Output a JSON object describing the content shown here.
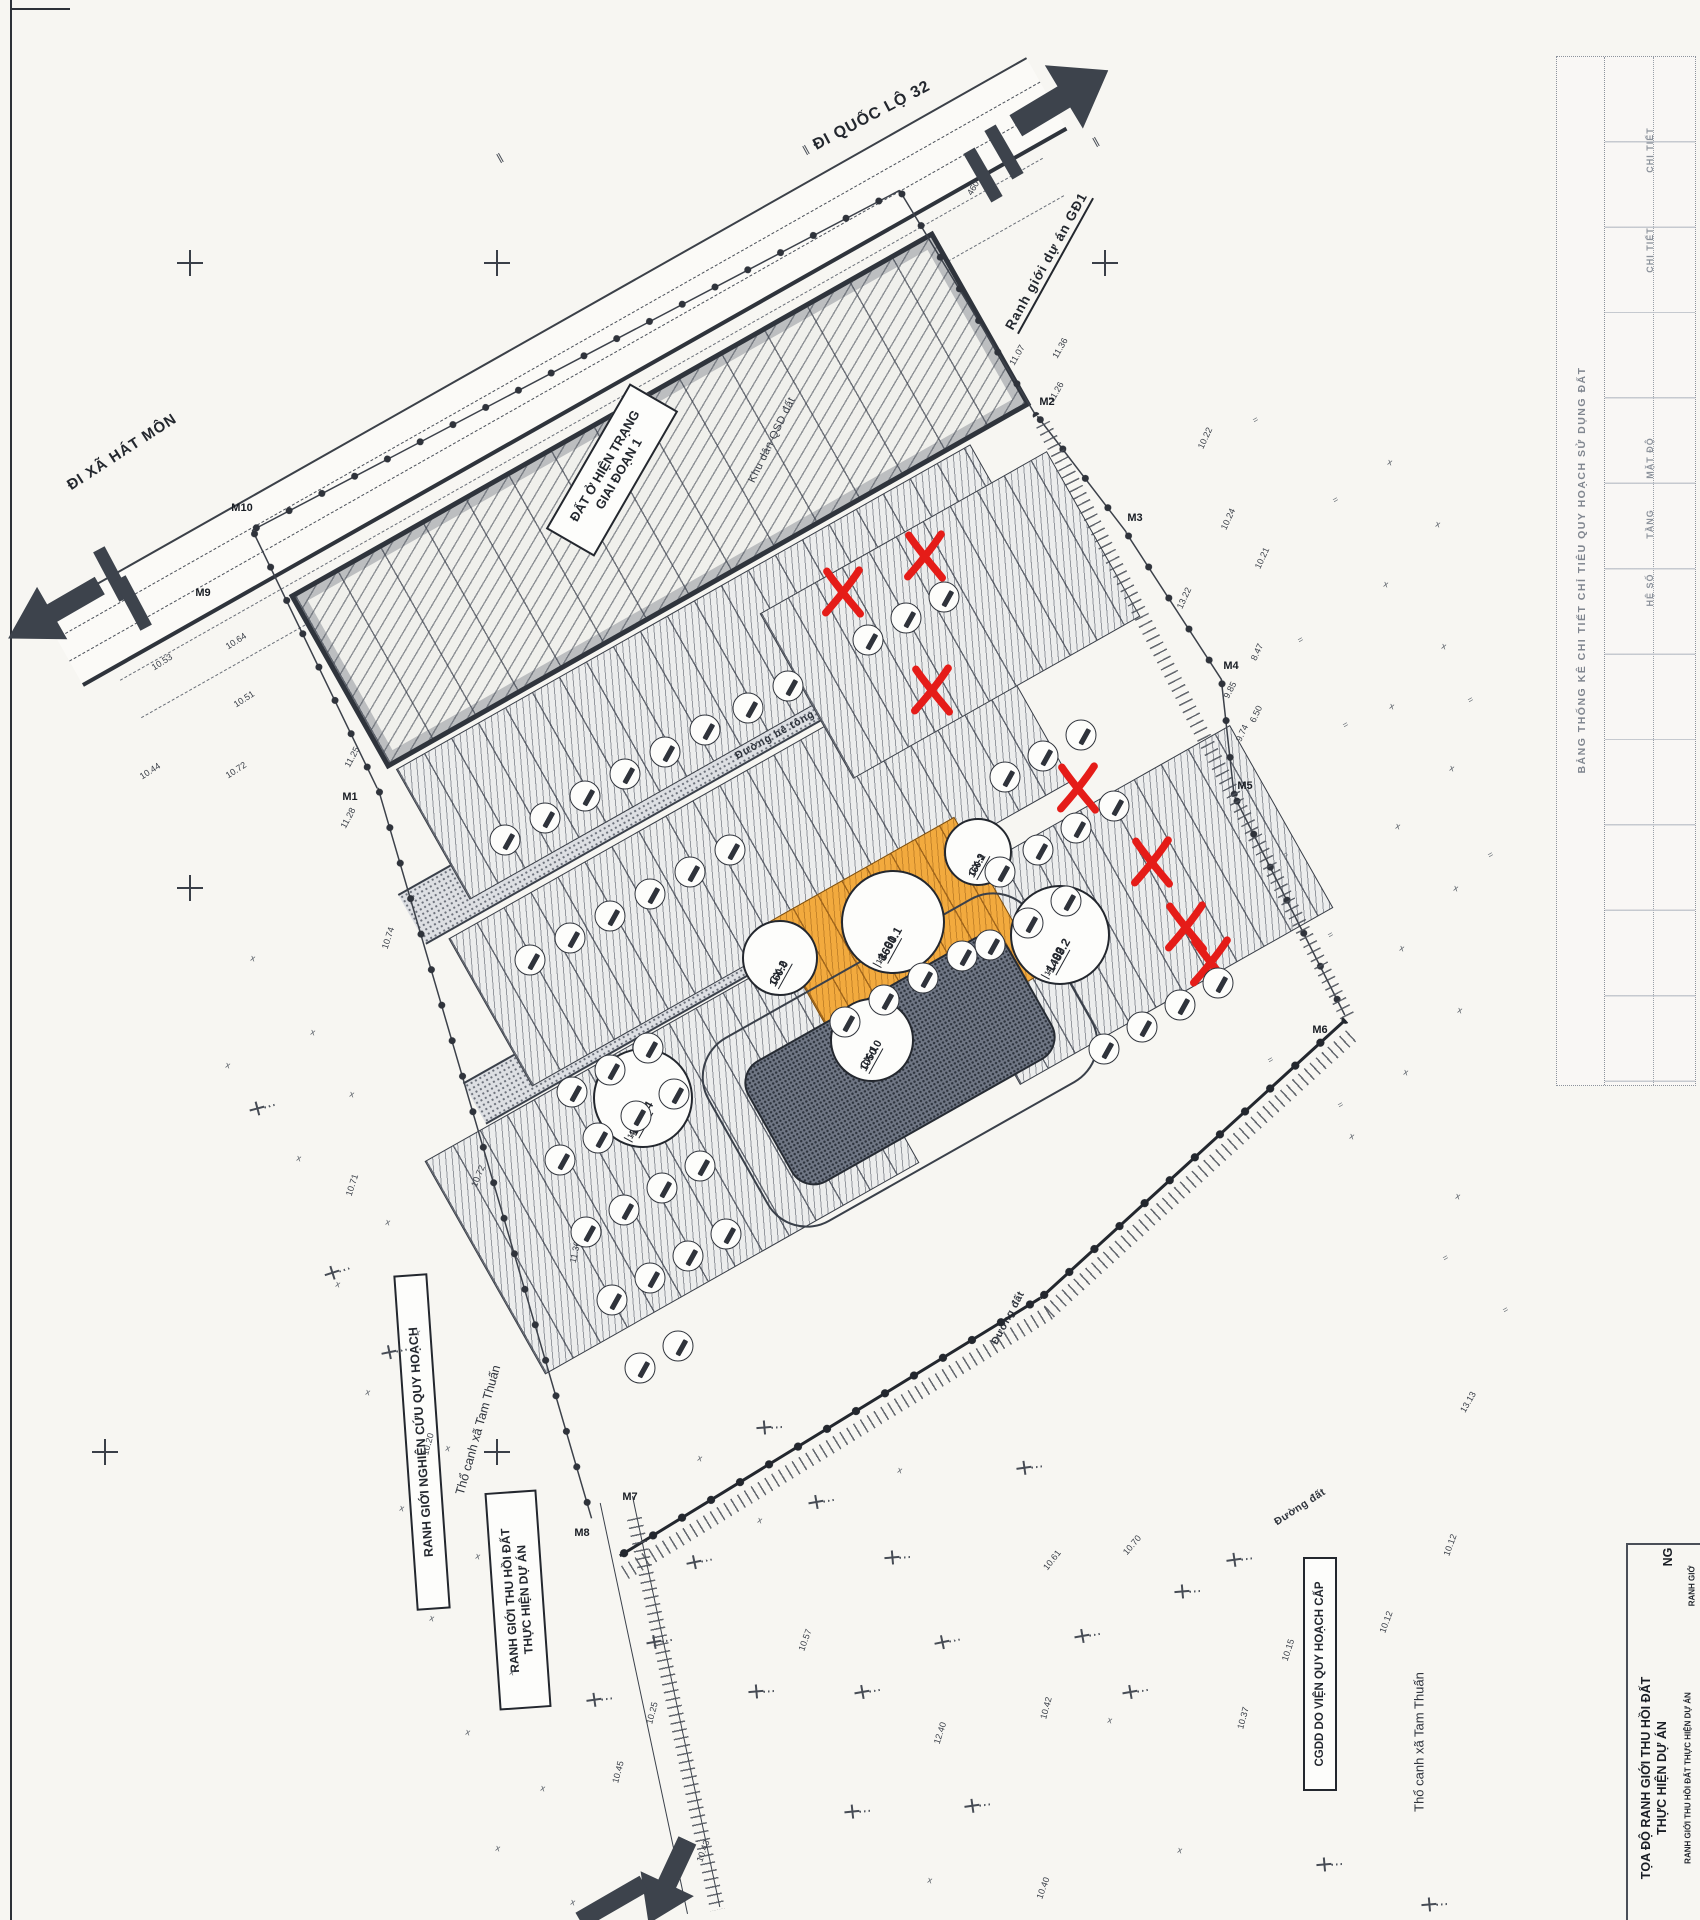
{
  "labels": {
    "ql32": "ĐI QUỐC LỘ 32",
    "hat_mon": "ĐI XÃ HÁT MÔN",
    "du_an_gd1": "Ranh giới dự án GĐ1",
    "hien_trang_1": "ĐẤT Ở HIỆN TRẠNG",
    "hien_trang_2": "GIAI ĐOẠN 1",
    "khu_dan": "Khu dân QSD đất",
    "duong_be_tong": "Đường bê tông",
    "duong_dat": "Đường đất",
    "tho_canh": "Thổ canh xã Tam Thuấn",
    "cgdd": "CGDD DO VIỆN QUY HOẠCH CẤP",
    "rg_nghien_cuu": "RANH GIỚI NGHIÊN CỨU QUY HOẠCH",
    "rg_thu_hoi_1": "RANH GIỚI THU HỒI ĐẤT",
    "rg_thu_hoi_2": "THỰC HIỆN DỰ ÁN",
    "toado_1": "TỌA ĐỘ RANH GIỚI THU HỒI ĐẤT",
    "toado_2": "THỰC HIỆN DỰ ÁN",
    "toado_sub": "RANH GIỚI THU HỒI ĐẤT THỰC HIỆN DỰ ÁN",
    "edge_frag_1": "NG",
    "edge_frag_2": "RANH GIỚ",
    "table_header": "BẢNG THỐNG KÊ CHI TIẾT CHỈ TIÊU QUY HOẠCH SỬ DỤNG ĐẤT",
    "table_cells": [
      "CHI TIẾT",
      "CHI TIẾT",
      "MẶT ĐỘ",
      "TẦNG",
      "HỆ SỐ"
    ]
  },
  "plots": [
    {
      "code": "CX-2",
      "area": "160.0",
      "cells": []
    },
    {
      "code": "L-01",
      "area": "3660.1",
      "cells": [
        "13",
        "4"
      ]
    },
    {
      "code": "CX-3",
      "area": "160.2",
      "cells": []
    },
    {
      "code": "L-02",
      "area": "1489.2",
      "cells": [
        "14",
        "4"
      ]
    },
    {
      "code": "L-03",
      "area": "1706.4",
      "cells": [
        "19",
        "4"
      ]
    },
    {
      "code": "CX-1",
      "area": "1050.0",
      "cells": []
    }
  ],
  "colors": {
    "ink": "#23272e",
    "highlight_orange": "#f2aa3e",
    "mark_red": "#e51c18",
    "paper": "#f7f6f2"
  },
  "m_markers": [
    {
      "label": "M1",
      "x": 350,
      "y": 797
    },
    {
      "label": "M2",
      "x": 1047,
      "y": 402
    },
    {
      "label": "M3",
      "x": 1135,
      "y": 518
    },
    {
      "label": "M4",
      "x": 1231,
      "y": 666
    },
    {
      "label": "M5",
      "x": 1245,
      "y": 786
    },
    {
      "label": "M6",
      "x": 1320,
      "y": 1030
    },
    {
      "label": "M7",
      "x": 630,
      "y": 1497
    },
    {
      "label": "M8",
      "x": 582,
      "y": 1533
    },
    {
      "label": "M9",
      "x": 203,
      "y": 593
    },
    {
      "label": "M10",
      "x": 242,
      "y": 508
    }
  ],
  "red_x_marks": [
    [
      843,
      592
    ],
    [
      925,
      556
    ],
    [
      932,
      690
    ],
    [
      1078,
      788
    ],
    [
      1152,
      862
    ],
    [
      1186,
      927
    ],
    [
      1211,
      962
    ]
  ],
  "elevations": [
    [
      "10.53",
      162,
      662,
      -33
    ],
    [
      "10.64",
      236,
      641,
      -33
    ],
    [
      "10.51",
      244,
      699,
      -33
    ],
    [
      "10.44",
      150,
      771,
      -33
    ],
    [
      "10.72",
      236,
      770,
      -33
    ],
    [
      "11.25",
      352,
      757,
      -62
    ],
    [
      "11.28",
      348,
      818,
      -62
    ],
    [
      "10.74",
      388,
      938,
      -72
    ],
    [
      "10.71",
      352,
      1185,
      -72
    ],
    [
      "10.72",
      478,
      1176,
      -68
    ],
    [
      "11.36",
      575,
      1252,
      -78
    ],
    [
      "10.20",
      428,
      1444,
      -75
    ],
    [
      "10.45",
      618,
      1772,
      -75
    ],
    [
      "10.25",
      652,
      1713,
      -75
    ],
    [
      "10.43",
      703,
      1851,
      -70
    ],
    [
      "12.40",
      940,
      1733,
      -72
    ],
    [
      "10.40",
      1043,
      1888,
      -70
    ],
    [
      "10.42",
      1046,
      1708,
      -75
    ],
    [
      "10.37",
      1243,
      1718,
      -75
    ],
    [
      "10.61",
      1052,
      1560,
      -52
    ],
    [
      "10.70",
      1132,
      1545,
      -50
    ],
    [
      "10.12",
      1450,
      1545,
      -70
    ],
    [
      "10.12",
      1386,
      1622,
      -70
    ],
    [
      "10.15",
      1288,
      1650,
      -72
    ],
    [
      "13.13",
      1468,
      1402,
      -60
    ],
    [
      "11.07",
      1017,
      355,
      -60
    ],
    [
      "11.36",
      1060,
      348,
      -60
    ],
    [
      "11.26",
      1056,
      392,
      -60
    ],
    [
      "10.22",
      1205,
      438,
      -65
    ],
    [
      "10.24",
      1228,
      519,
      -65
    ],
    [
      "13.22",
      1184,
      598,
      -65
    ],
    [
      "10.21",
      1262,
      558,
      -65
    ],
    [
      "8.47",
      1257,
      652,
      -65
    ],
    [
      "6.50",
      1256,
      714,
      -65
    ],
    [
      "9.74",
      1242,
      733,
      -65
    ],
    [
      "9.85",
      1230,
      690,
      -62
    ],
    [
      "460",
      973,
      188,
      -60
    ],
    [
      "10.57",
      805,
      1640,
      -70
    ]
  ],
  "veg_marks": [
    [
      313,
      1032
    ],
    [
      352,
      1094
    ],
    [
      299,
      1158
    ],
    [
      388,
      1222
    ],
    [
      338,
      1284
    ],
    [
      418,
      1332
    ],
    [
      368,
      1392
    ],
    [
      448,
      1448
    ],
    [
      402,
      1508
    ],
    [
      478,
      1556
    ],
    [
      432,
      1618
    ],
    [
      512,
      1672
    ],
    [
      468,
      1732
    ],
    [
      543,
      1788
    ],
    [
      498,
      1848
    ],
    [
      573,
      1902
    ],
    [
      253,
      958
    ],
    [
      228,
      1065
    ],
    [
      1390,
      462
    ],
    [
      1438,
      524
    ],
    [
      1386,
      584
    ],
    [
      1444,
      646
    ],
    [
      1392,
      706
    ],
    [
      1452,
      768
    ],
    [
      1398,
      826
    ],
    [
      1456,
      888
    ],
    [
      1402,
      948
    ],
    [
      1460,
      1010
    ],
    [
      1406,
      1072
    ],
    [
      1352,
      1136
    ],
    [
      1458,
      1196
    ],
    [
      700,
      1458
    ],
    [
      760,
      1520
    ],
    [
      900,
      1470
    ],
    [
      1110,
      1720
    ],
    [
      930,
      1880
    ],
    [
      1180,
      1850
    ]
  ],
  "eq_marks": [
    [
      1335,
      500
    ],
    [
      1300,
      640
    ],
    [
      1345,
      725
    ],
    [
      1285,
      855
    ],
    [
      1330,
      935
    ],
    [
      1270,
      1060
    ],
    [
      1340,
      1105
    ],
    [
      1255,
      420
    ],
    [
      1470,
      700
    ],
    [
      1490,
      855
    ],
    [
      1445,
      1258
    ],
    [
      1505,
      1310
    ]
  ],
  "graves": [
    [
      263,
      1108,
      -15
    ],
    [
      338,
      1272,
      -18
    ],
    [
      395,
      1352,
      -12
    ],
    [
      770,
      1428,
      -5
    ],
    [
      822,
      1502,
      -10
    ],
    [
      700,
      1562,
      -12
    ],
    [
      898,
      1558,
      -5
    ],
    [
      1088,
      1636,
      -10
    ],
    [
      1188,
      1592,
      -5
    ],
    [
      948,
      1642,
      -12
    ],
    [
      1030,
      1468,
      -8
    ],
    [
      868,
      1692,
      -10
    ],
    [
      762,
      1692,
      -5
    ],
    [
      978,
      1806,
      -8
    ],
    [
      858,
      1812,
      -6
    ],
    [
      1136,
      1692,
      -10
    ],
    [
      660,
      1642,
      -10
    ],
    [
      600,
      1700,
      -8
    ],
    [
      1240,
      1560,
      -8
    ],
    [
      1330,
      1865,
      -5
    ],
    [
      1435,
      1905,
      -5
    ]
  ],
  "grid_crosses": [
    [
      190,
      263
    ],
    [
      497,
      263
    ],
    [
      1105,
      263
    ],
    [
      190,
      888
    ],
    [
      105,
      1452
    ],
    [
      497,
      1452
    ]
  ],
  "top_ticks": [
    [
      500,
      158
    ],
    [
      806,
      150
    ],
    [
      1096,
      142
    ]
  ],
  "lot_markers": [
    [
      505,
      840
    ],
    [
      545,
      818
    ],
    [
      585,
      796
    ],
    [
      625,
      774
    ],
    [
      665,
      752
    ],
    [
      705,
      730
    ],
    [
      748,
      708
    ],
    [
      788,
      686
    ],
    [
      530,
      960
    ],
    [
      570,
      938
    ],
    [
      610,
      916
    ],
    [
      650,
      894
    ],
    [
      690,
      872
    ],
    [
      730,
      850
    ],
    [
      868,
      640
    ],
    [
      906,
      618
    ],
    [
      944,
      597
    ],
    [
      1005,
      777
    ],
    [
      1043,
      756
    ],
    [
      1081,
      735
    ],
    [
      845,
      1022
    ],
    [
      884,
      1000
    ],
    [
      923,
      978
    ],
    [
      962,
      956
    ],
    [
      1000,
      872
    ],
    [
      1038,
      850
    ],
    [
      1076,
      828
    ],
    [
      1114,
      806
    ],
    [
      990,
      945
    ],
    [
      1028,
      923
    ],
    [
      1066,
      901
    ],
    [
      1180,
      1005
    ],
    [
      1142,
      1027
    ],
    [
      1104,
      1049
    ],
    [
      1218,
      983
    ],
    [
      572,
      1092
    ],
    [
      610,
      1070
    ],
    [
      648,
      1048
    ],
    [
      560,
      1160
    ],
    [
      598,
      1138
    ],
    [
      636,
      1116
    ],
    [
      674,
      1094
    ],
    [
      586,
      1232
    ],
    [
      624,
      1210
    ],
    [
      662,
      1188
    ],
    [
      700,
      1166
    ],
    [
      612,
      1300
    ],
    [
      650,
      1278
    ],
    [
      688,
      1256
    ],
    [
      726,
      1234
    ],
    [
      640,
      1368
    ],
    [
      678,
      1346
    ]
  ],
  "boundary_segments": [
    {
      "cx": 315,
      "cy": 659,
      "len": 287,
      "rot": 64.2,
      "heavy": false
    },
    {
      "cx": 485,
      "cy": 1153,
      "len": 761,
      "rot": 73.7,
      "heavy": false
    },
    {
      "cx": 830,
      "cy": 1427,
      "len": 493,
      "rot": -31.5,
      "heavy": true
    },
    {
      "cx": 1193,
      "cy": 1159,
      "len": 413,
      "rot": -42.4,
      "heavy": true
    },
    {
      "cx": 1290,
      "cy": 906,
      "len": 244,
      "rot": 63.2,
      "heavy": false
    },
    {
      "cx": 1228,
      "cy": 738,
      "len": 118,
      "rot": 83.7,
      "heavy": false
    },
    {
      "cx": 1174,
      "cy": 606,
      "len": 176,
      "rot": 57,
      "heavy": false
    },
    {
      "cx": 1082,
      "cy": 474,
      "len": 146,
      "rot": 52.5,
      "heavy": false
    },
    {
      "cx": 576,
      "cy": 360,
      "len": 731,
      "rot": -27.7,
      "heavy": false
    },
    {
      "cx": 968,
      "cy": 303,
      "len": 264,
      "rot": 58.8,
      "heavy": false
    }
  ],
  "tick_bands": [
    {
      "cx": 838,
      "cy": 1442,
      "len": 500,
      "rot": -31.5
    },
    {
      "cx": 1202,
      "cy": 1172,
      "len": 415,
      "rot": -42.4
    },
    {
      "cx": 1196,
      "cy": 722,
      "len": 670,
      "rot": 62.8
    },
    {
      "cx": 676,
      "cy": 1714,
      "len": 400,
      "rot": 78
    }
  ],
  "end_bars": [
    {
      "x": 112,
      "y": 574,
      "rot": 62
    },
    {
      "x": 133,
      "y": 603,
      "rot": 62
    },
    {
      "x": 1004,
      "y": 152,
      "rot": 60
    },
    {
      "x": 983,
      "y": 175,
      "rot": 60
    }
  ]
}
